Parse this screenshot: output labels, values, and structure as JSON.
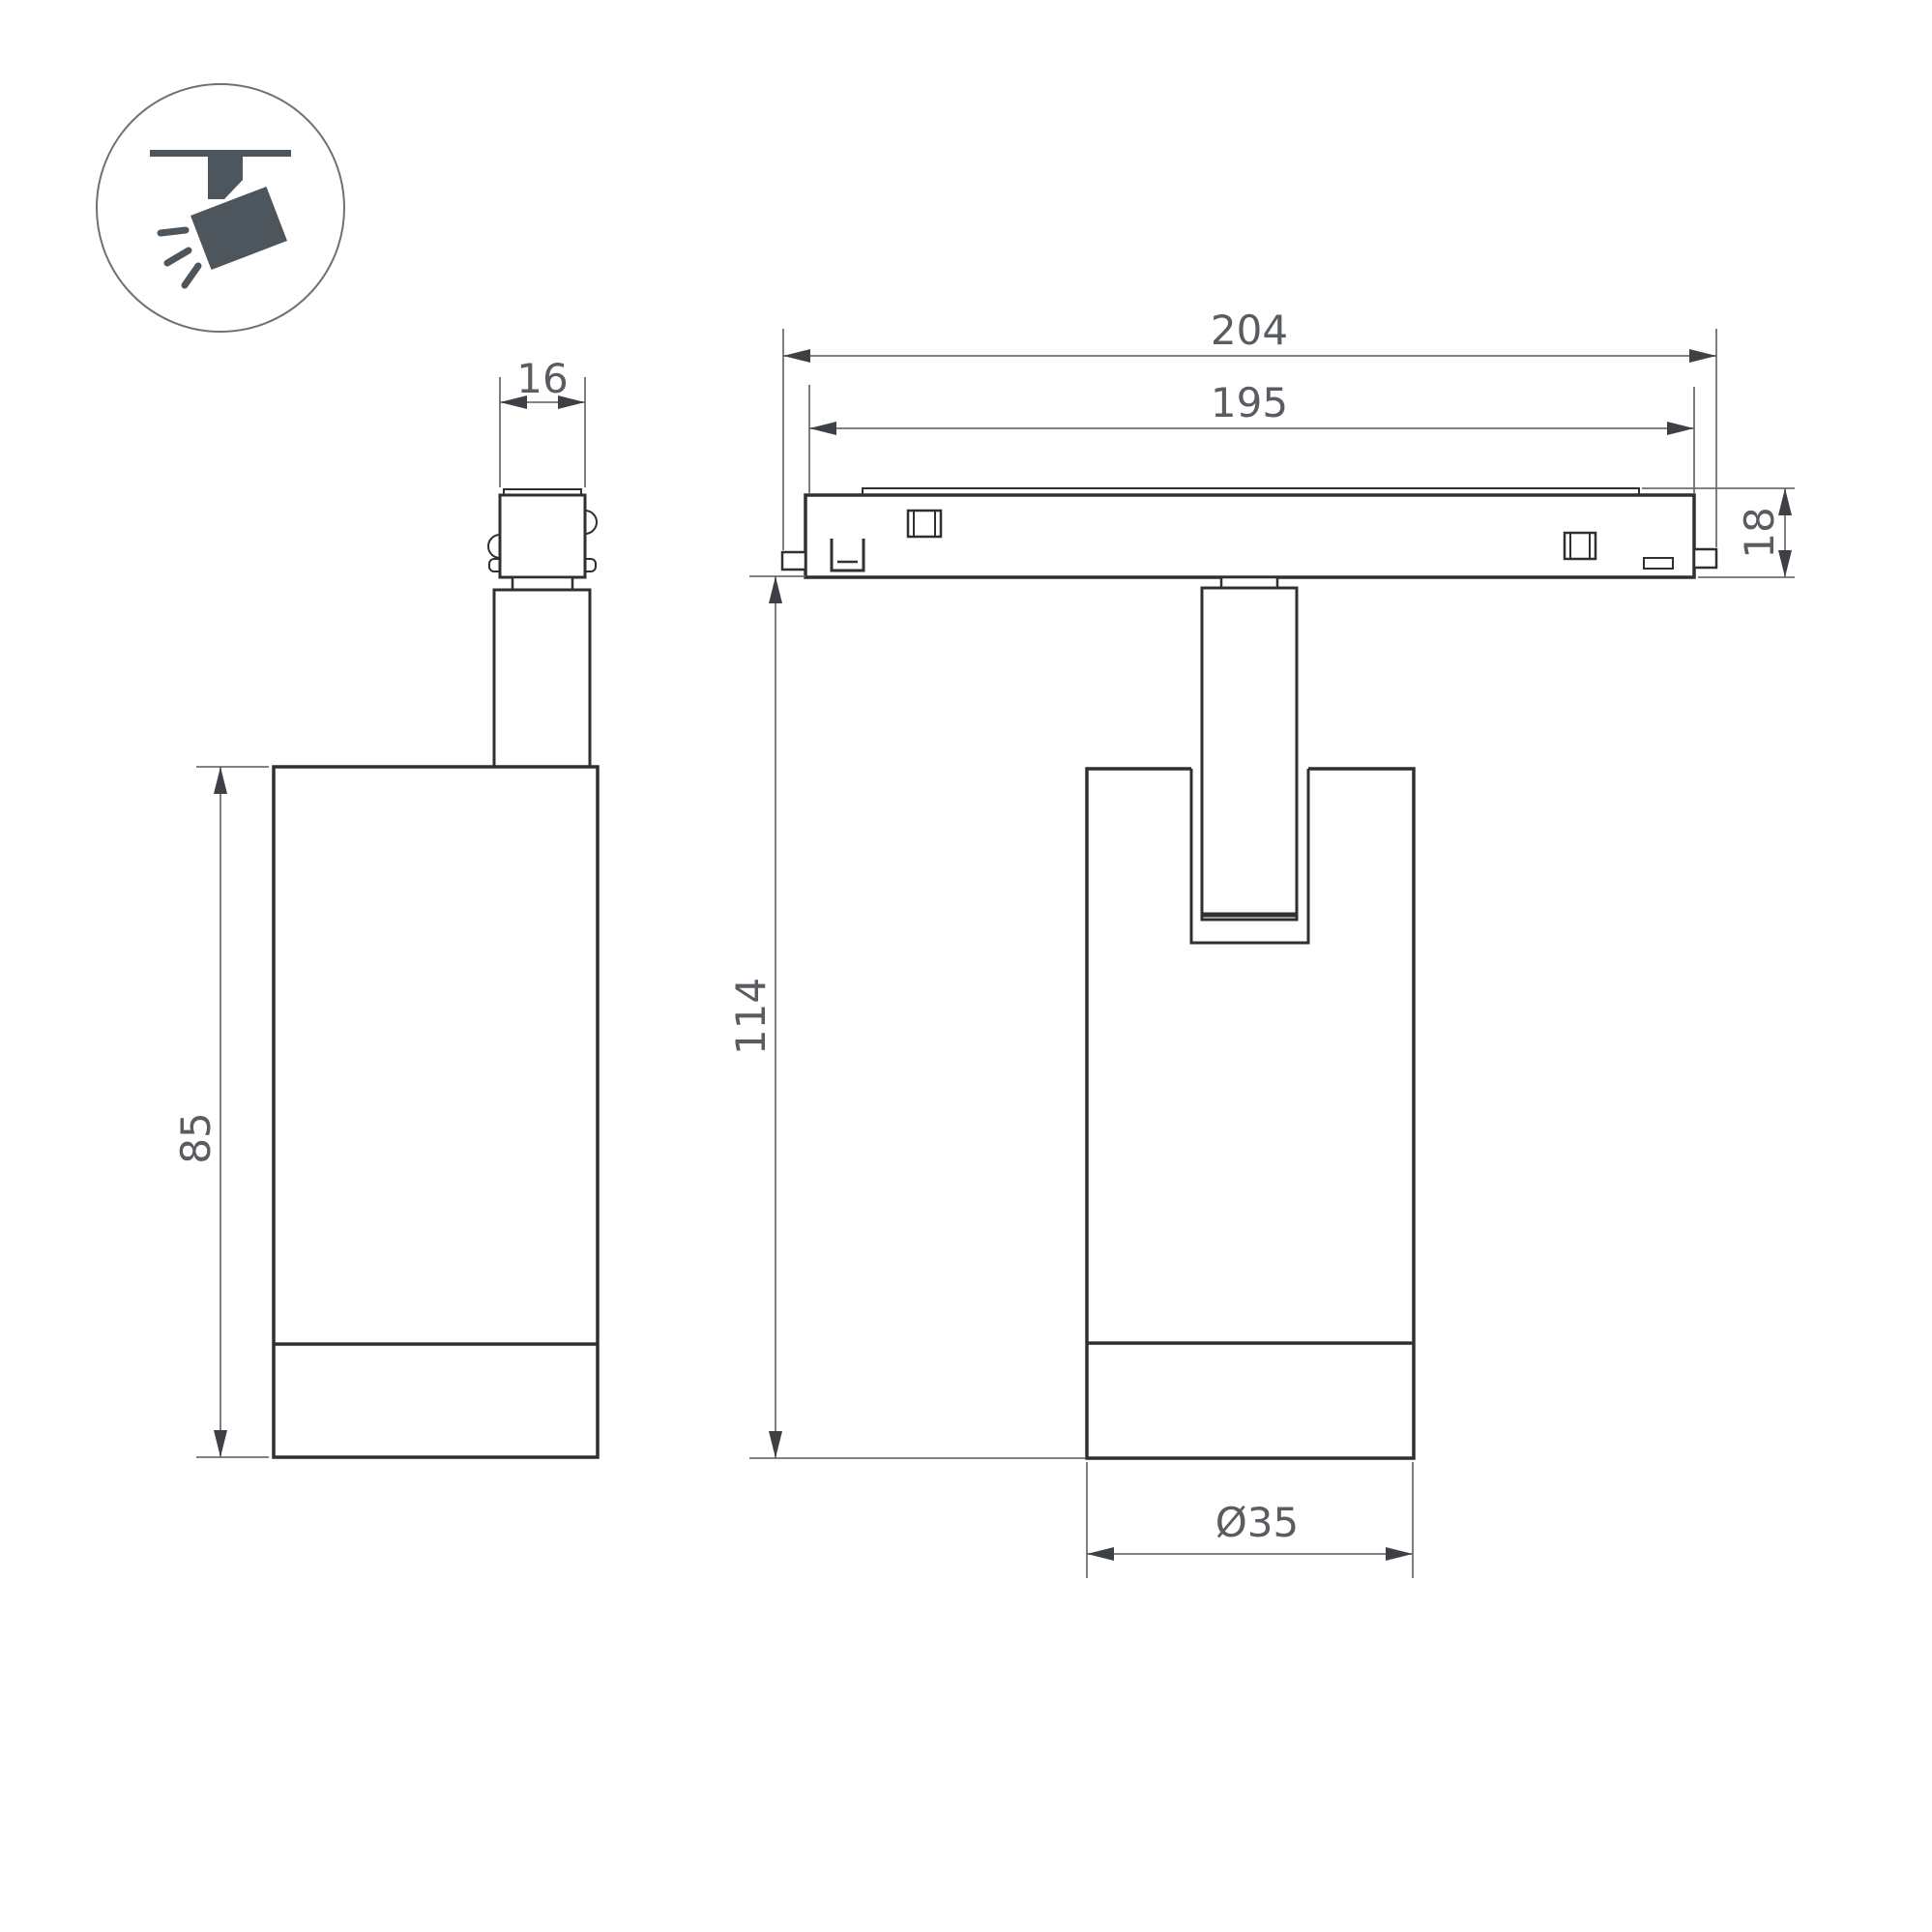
{
  "colors": {
    "line": "#2e3134",
    "dim": "#6d7175",
    "arrow": "#3d4145",
    "text": "#595d61",
    "icon": "#4d565c",
    "bg": "#ffffff"
  },
  "icon": {
    "label": "ceiling-track-spotlight-pictogram"
  },
  "dimensions": {
    "adapter_width": "16",
    "overall_length": "204",
    "track_length": "195",
    "track_height": "18",
    "body_height": "85",
    "overall_height": "114",
    "diameter": "Ø35"
  }
}
